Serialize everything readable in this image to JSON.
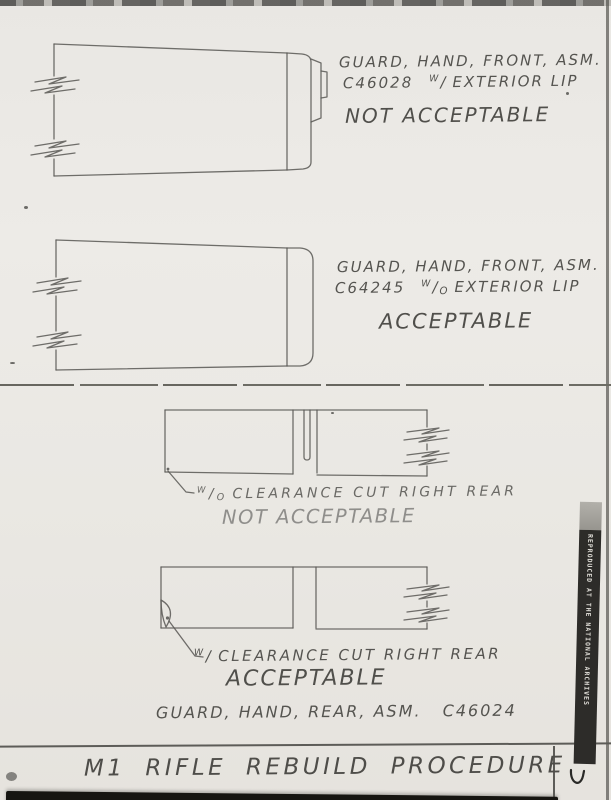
{
  "colors": {
    "paper": "#e9e7e3",
    "ink": "#555450",
    "line": "#5c5b58",
    "strip_bg": "#2d2c29",
    "strip_text": "#dedcd6",
    "bottom_bar": "#161511"
  },
  "page": {
    "title": "M1 RIFLE REBUILD PROCEDURE",
    "archives_strip_label": "REPRODUCED AT THE NATIONAL ARCHIVES"
  },
  "sections": [
    {
      "id": "front-guard-with-lip",
      "part_line": "GUARD, HAND, FRONT, ASM.",
      "part_number": "C46028",
      "note": {
        "sup": "W",
        "slash": "/",
        "sub": "",
        "rest": "EXTERIOR LIP"
      },
      "verdict": "NOT ACCEPTABLE"
    },
    {
      "id": "front-guard-without-lip",
      "part_line": "GUARD, HAND, FRONT, ASM.",
      "part_number": "C64245",
      "note": {
        "sup": "W",
        "slash": "/",
        "sub": "O",
        "rest": "EXTERIOR LIP"
      },
      "verdict": "ACCEPTABLE"
    },
    {
      "id": "rear-guard-without-clearance-cut",
      "note": {
        "sup": "W",
        "slash": "/",
        "sub": "O",
        "rest": "CLEARANCE CUT RIGHT REAR"
      },
      "verdict": "NOT ACCEPTABLE"
    },
    {
      "id": "rear-guard-with-clearance-cut",
      "note": {
        "sup": "W",
        "slash": "/",
        "sub": "",
        "rest": "CLEARANCE CUT RIGHT REAR"
      },
      "verdict": "ACCEPTABLE",
      "part_line": "GUARD, HAND, REAR, ASM.",
      "part_number": "C46024"
    }
  ]
}
